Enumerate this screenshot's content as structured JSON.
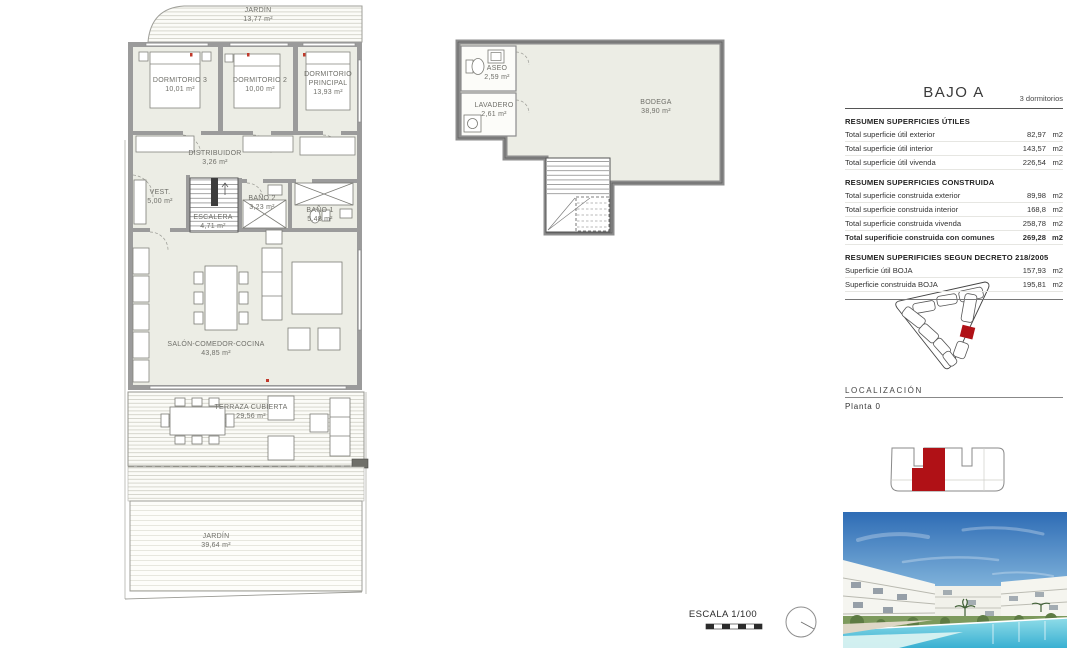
{
  "summary": {
    "title": "BAJO A",
    "subtitle": "3 dormitorios",
    "sections": [
      {
        "heading": "RESUMEN SUPERFICIES ÚTILES",
        "rows": [
          {
            "label": "Total superficie útil exterior",
            "value": "82,97",
            "unit": "m2"
          },
          {
            "label": "Total superficie útil interior",
            "value": "143,57",
            "unit": "m2"
          },
          {
            "label": "Total superficie útil vivenda",
            "value": "226,54",
            "unit": "m2"
          }
        ]
      },
      {
        "heading": "RESUMEN SUPERFICIES CONSTRUIDA",
        "rows": [
          {
            "label": "Total superficie construida exterior",
            "value": "89,98",
            "unit": "m2"
          },
          {
            "label": "Total superficie construida interior",
            "value": "168,8",
            "unit": "m2"
          },
          {
            "label": "Total superficie construida vivenda",
            "value": "258,78",
            "unit": "m2"
          },
          {
            "label": "Total superificie construida con comunes",
            "value": "269,28",
            "unit": "m2"
          }
        ]
      },
      {
        "heading": "RESUMEN SUPERIFICIES SEGUN DECRETO 218/2005",
        "rows": [
          {
            "label": "Superficie útil BOJA",
            "value": "157,93",
            "unit": "m2"
          },
          {
            "label": "Superficie construida BOJA",
            "value": "195,81",
            "unit": "m2"
          }
        ]
      }
    ]
  },
  "floorplan_main": {
    "rooms": [
      {
        "id": "jardin-top",
        "name": "JARDÍN",
        "area": "13,77 m²"
      },
      {
        "id": "dormitorio-3",
        "name": "DORMITORIO 3",
        "area": "10,01 m²"
      },
      {
        "id": "dormitorio-2",
        "name": "DORMITORIO 2",
        "area": "10,00 m²"
      },
      {
        "id": "principal",
        "name": "DORMITORIO PRINCIPAL",
        "area": "13,93 m²"
      },
      {
        "id": "distribuidor",
        "name": "DISTRIBUIDOR",
        "area": "3,26 m²"
      },
      {
        "id": "vestidor",
        "name": "VEST.",
        "area": "5,00 m²"
      },
      {
        "id": "escalera",
        "name": "ESCALERA",
        "area": "4,71 m²"
      },
      {
        "id": "bano-2",
        "name": "BAÑO 2",
        "area": "3,23 m²"
      },
      {
        "id": "bano-1",
        "name": "BAÑO 1",
        "area": "5,48 m²"
      },
      {
        "id": "salon",
        "name": "SALÓN-COMEDOR-COCINA",
        "area": "43,85 m²"
      },
      {
        "id": "terraza",
        "name": "TERRAZA CUBIERTA",
        "area": "29,56 m²"
      },
      {
        "id": "jardin-bajo",
        "name": "JARDÍN",
        "area": "39,64 m²"
      }
    ]
  },
  "floorplan_basement": {
    "rooms": [
      {
        "id": "aseo",
        "name": "ASEO",
        "area": "2,59 m²"
      },
      {
        "id": "lavadero",
        "name": "LAVADERO",
        "area": "2,61 m²"
      },
      {
        "id": "bodega",
        "name": "BODEGA",
        "area": "38,90 m²"
      }
    ]
  },
  "localizacion": {
    "heading": "LOCALIZACIÓN",
    "planta": "Planta 0"
  },
  "scale": {
    "label": "ESCALA 1/100"
  },
  "colors": {
    "accent_red": "#b01116",
    "wall_gray": "#9b9b9b",
    "room_fill": "#ecede5"
  }
}
